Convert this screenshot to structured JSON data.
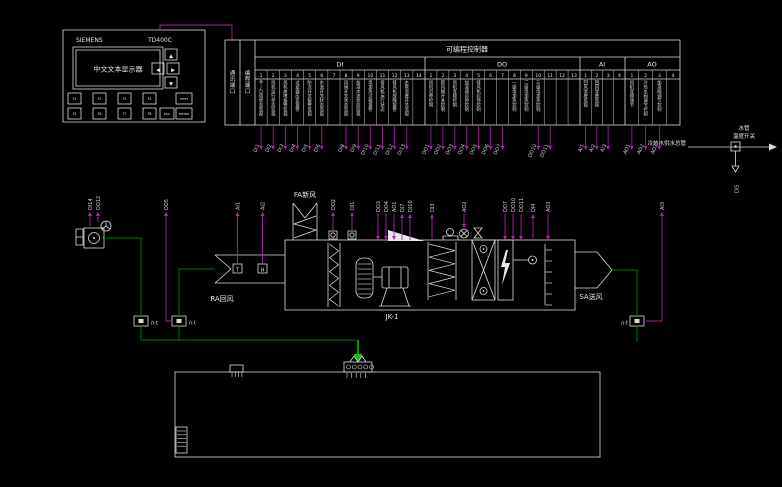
{
  "panel": {
    "brand": "SIEMENS",
    "model": "TD400C",
    "display_text": "中文文本显示器",
    "nav_keys": [
      "▲",
      "◀",
      "▶",
      "▼"
    ],
    "function_keys_row1": [
      "F1",
      "F2",
      "F3",
      "F4"
    ],
    "function_keys_row2": [
      "F5",
      "F6",
      "F7",
      "F8"
    ],
    "shift_key": "SHIFT",
    "esc_key": "ESC",
    "enter_key": "ENTER"
  },
  "plc": {
    "title": "可编程控制器",
    "ports": [
      "通讯端口",
      "编程端口"
    ],
    "sections": [
      {
        "name": "DI",
        "count": 14,
        "labels": {
          "1": "手/自动状态监视",
          "2": "风机运行状态监视",
          "3": "风机故障报警监视",
          "4": "过滤器压差报警",
          "5": "防冻开关报警监视",
          "6": "水流开关状态监视",
          "8": "风阀开关状态监视",
          "9": "加湿水流状态监视",
          "10": "电加热过载报警",
          "11": "排风机运行状态",
          "12": "排风机故障报警",
          "13": "水管温度开关监视"
        }
      },
      {
        "name": "DO",
        "count": 13,
        "labels": {
          "1": "风机启停控制",
          "2": "新风阀开关控制",
          "3": "风机变频控制",
          "4": "加湿器启停控制",
          "5": "排风机启停控制",
          "8": "一级电加热控制",
          "9": "二级电加热控制",
          "10": "三级电加热控制"
        }
      },
      {
        "name": "AI",
        "count": 4,
        "labels": {
          "1": "回风温度监视",
          "2": "回风湿度监视"
        }
      },
      {
        "name": "AO",
        "count": 4,
        "labels": {
          "1": "风机变频调节",
          "2": "冷热水阀调节控制",
          "3": "加湿阀调节控制"
        }
      }
    ],
    "drops": [
      {
        "s": "DI",
        "c": 1,
        "label": "DI1"
      },
      {
        "s": "DI",
        "c": 2,
        "label": "DI2"
      },
      {
        "s": "DI",
        "c": 3,
        "label": "DI3"
      },
      {
        "s": "DI",
        "c": 4,
        "label": "DI4"
      },
      {
        "s": "DI",
        "c": 5,
        "label": "DI5"
      },
      {
        "s": "DI",
        "c": 6,
        "label": "DI6"
      },
      {
        "s": "DI",
        "c": 8,
        "label": "DI8"
      },
      {
        "s": "DI",
        "c": 9,
        "label": "DI9"
      },
      {
        "s": "DI",
        "c": 10,
        "label": "DI10"
      },
      {
        "s": "DI",
        "c": 11,
        "label": "DI11"
      },
      {
        "s": "DI",
        "c": 12,
        "label": "DI12"
      },
      {
        "s": "DI",
        "c": 13,
        "label": "DI13"
      },
      {
        "s": "DO",
        "c": 1,
        "label": "DO1"
      },
      {
        "s": "DO",
        "c": 2,
        "label": "DO2"
      },
      {
        "s": "DO",
        "c": 3,
        "label": "DO3"
      },
      {
        "s": "DO",
        "c": 4,
        "label": "DO4"
      },
      {
        "s": "DO",
        "c": 5,
        "label": "DO5"
      },
      {
        "s": "DO",
        "c": 6,
        "label": "DO6"
      },
      {
        "s": "DO",
        "c": 7,
        "label": "DO7"
      },
      {
        "s": "DO",
        "c": 10,
        "label": "DO10"
      },
      {
        "s": "DO",
        "c": 11,
        "label": "DO11"
      },
      {
        "s": "AI",
        "c": 1,
        "label": "AI1"
      },
      {
        "s": "AI",
        "c": 2,
        "label": "AI2"
      },
      {
        "s": "AI",
        "c": 3,
        "label": "AI3"
      },
      {
        "s": "AO",
        "c": 1,
        "label": "AO1"
      },
      {
        "s": "AO",
        "c": 2,
        "label": "AO2"
      },
      {
        "s": "AO",
        "c": 3,
        "label": "AO3"
      }
    ]
  },
  "diagram": {
    "tags": [
      "DI14",
      "DO12",
      "DO5",
      "AI1",
      "AI2",
      "DO2",
      "DI1",
      "DO3",
      "DO4",
      "AO1",
      "DI7",
      "DI10",
      "DI3",
      "AO2",
      "DO7",
      "DO10",
      "DO11",
      "DI4",
      "AO3",
      "AI3",
      "DI5"
    ]
  },
  "labels": {
    "fa_duct": "FA新风",
    "ra_duct": "RA回风",
    "sa_duct": "SA送风",
    "unit": "JK-1",
    "main_pipe": "冷热水供水总管",
    "pipe_switch_line1": "水管",
    "pipe_switch_line2": "温度开关",
    "sensor_module": "n:t",
    "ra_temp_sensor": "T",
    "ra_humidity_sensor": "H"
  },
  "colors": {
    "line": "#dcdcdc",
    "signal": "#a828a8",
    "pipe_green": "#007a00",
    "arrow_green": "#00cc00"
  }
}
